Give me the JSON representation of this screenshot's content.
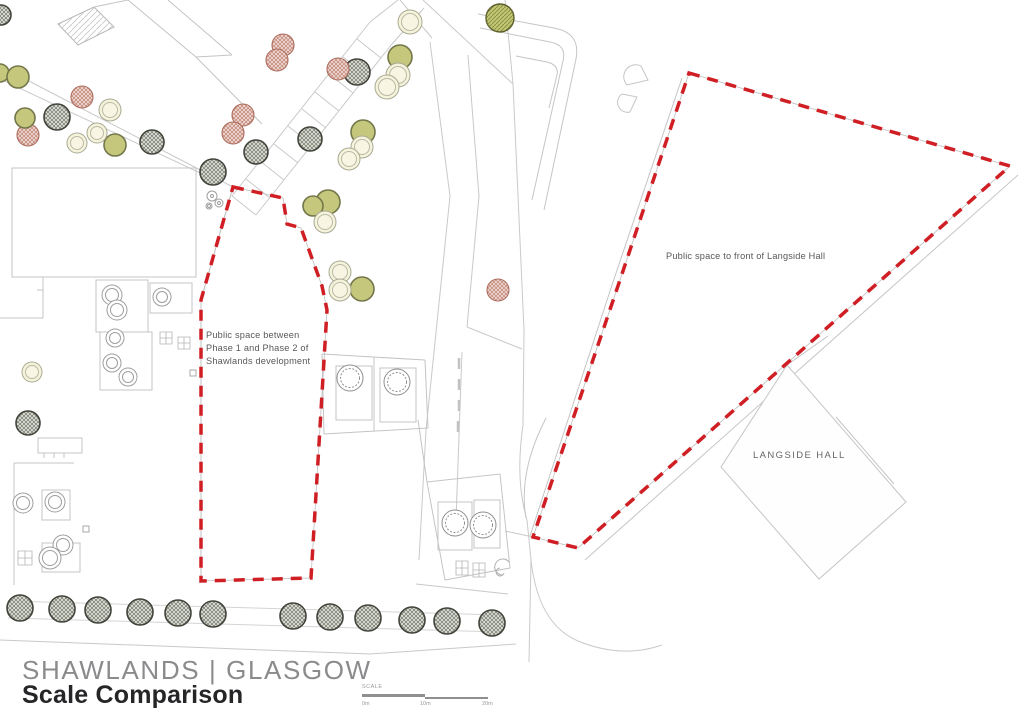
{
  "title": {
    "location": "SHAWLANDS | GLASGOW",
    "project": "Scale Comparison"
  },
  "scale_bar": {
    "label": "SCALE",
    "ticks": [
      "0m",
      "10m",
      "20m"
    ]
  },
  "left_map": {
    "annotation_lines": [
      "Public space between",
      "Phase 1 and Phase 2 of",
      "Shawlands development"
    ]
  },
  "right_map": {
    "annotation": "Public space to front of Langside Hall",
    "building_label": "LANGSIDE HALL"
  },
  "colors": {
    "boundary_red": "#d01f24",
    "map_line": "#c9c9c9",
    "tree_dark_outline": "#41443b",
    "tree_rust_outline": "#ad6c5e",
    "tree_olive_fill": "#c5c77c",
    "tree_pale_fill": "#f5f3da",
    "title_gray": "#8b8b8e",
    "title_black": "#262628"
  },
  "map_geometry": {
    "boundaries": [
      {
        "name": "shawlands-public-space-boundary",
        "points": [
          [
            233,
            187
          ],
          [
            283,
            198
          ],
          [
            287,
            224
          ],
          [
            301,
            228
          ],
          [
            322,
            286
          ],
          [
            327,
            310
          ],
          [
            311,
            578
          ],
          [
            201,
            581
          ],
          [
            201,
            300
          ]
        ]
      },
      {
        "name": "langside-public-space-boundary",
        "points": [
          [
            689,
            73
          ],
          [
            1010,
            166
          ],
          [
            578,
            548
          ],
          [
            533,
            537
          ],
          [
            620,
            280
          ]
        ]
      }
    ],
    "trees": [
      {
        "type": "dark",
        "x": 1,
        "y": 15,
        "r": 10
      },
      {
        "type": "dark",
        "x": 57,
        "y": 117,
        "r": 13
      },
      {
        "type": "dark",
        "x": 152,
        "y": 142,
        "r": 12
      },
      {
        "type": "dark",
        "x": 213,
        "y": 172,
        "r": 13
      },
      {
        "type": "dark",
        "x": 256,
        "y": 152,
        "r": 12
      },
      {
        "type": "dark",
        "x": 357,
        "y": 72,
        "r": 13
      },
      {
        "type": "dark",
        "x": 310,
        "y": 139,
        "r": 12
      },
      {
        "type": "dark",
        "x": 28,
        "y": 423,
        "r": 12
      },
      {
        "type": "dark",
        "x": 20,
        "y": 608,
        "r": 13
      },
      {
        "type": "dark",
        "x": 62,
        "y": 609,
        "r": 13
      },
      {
        "type": "dark",
        "x": 98,
        "y": 610,
        "r": 13
      },
      {
        "type": "dark",
        "x": 140,
        "y": 612,
        "r": 13
      },
      {
        "type": "dark",
        "x": 178,
        "y": 613,
        "r": 13
      },
      {
        "type": "dark",
        "x": 213,
        "y": 614,
        "r": 13
      },
      {
        "type": "dark",
        "x": 293,
        "y": 616,
        "r": 13
      },
      {
        "type": "dark",
        "x": 330,
        "y": 617,
        "r": 13
      },
      {
        "type": "dark",
        "x": 368,
        "y": 618,
        "r": 13
      },
      {
        "type": "dark",
        "x": 412,
        "y": 620,
        "r": 13
      },
      {
        "type": "dark",
        "x": 447,
        "y": 621,
        "r": 13
      },
      {
        "type": "dark",
        "x": 492,
        "y": 623,
        "r": 13
      },
      {
        "type": "oliveHatch",
        "x": 500,
        "y": 18,
        "r": 14
      },
      {
        "type": "rust",
        "x": 28,
        "y": 135,
        "r": 11
      },
      {
        "type": "rust",
        "x": 82,
        "y": 97,
        "r": 11
      },
      {
        "type": "rust",
        "x": 243,
        "y": 115,
        "r": 11
      },
      {
        "type": "rust",
        "x": 233,
        "y": 133,
        "r": 11
      },
      {
        "type": "rust",
        "x": 283,
        "y": 45,
        "r": 11
      },
      {
        "type": "rust",
        "x": 277,
        "y": 60,
        "r": 11
      },
      {
        "type": "rust",
        "x": 338,
        "y": 69,
        "r": 11
      },
      {
        "type": "rust",
        "x": 498,
        "y": 290,
        "r": 11
      },
      {
        "type": "olive",
        "x": 0,
        "y": 73,
        "r": 9
      },
      {
        "type": "olive",
        "x": 18,
        "y": 77,
        "r": 11
      },
      {
        "type": "olive",
        "x": 25,
        "y": 118,
        "r": 10
      },
      {
        "type": "olive",
        "x": 115,
        "y": 145,
        "r": 11
      },
      {
        "type": "olive",
        "x": 400,
        "y": 57,
        "r": 12
      },
      {
        "type": "olive",
        "x": 363,
        "y": 132,
        "r": 12
      },
      {
        "type": "olive",
        "x": 328,
        "y": 202,
        "r": 12
      },
      {
        "type": "olive",
        "x": 313,
        "y": 206,
        "r": 10
      },
      {
        "type": "olive",
        "x": 362,
        "y": 289,
        "r": 12
      },
      {
        "type": "pale",
        "x": 110,
        "y": 110,
        "r": 11
      },
      {
        "type": "pale",
        "x": 97,
        "y": 133,
        "r": 10
      },
      {
        "type": "pale",
        "x": 77,
        "y": 143,
        "r": 10
      },
      {
        "type": "pale",
        "x": 410,
        "y": 22,
        "r": 12
      },
      {
        "type": "pale",
        "x": 398,
        "y": 75,
        "r": 12
      },
      {
        "type": "pale",
        "x": 387,
        "y": 87,
        "r": 12
      },
      {
        "type": "pale",
        "x": 362,
        "y": 147,
        "r": 11
      },
      {
        "type": "pale",
        "x": 349,
        "y": 159,
        "r": 11
      },
      {
        "type": "pale",
        "x": 325,
        "y": 222,
        "r": 11
      },
      {
        "type": "pale",
        "x": 340,
        "y": 272,
        "r": 11
      },
      {
        "type": "pale",
        "x": 340,
        "y": 290,
        "r": 11
      },
      {
        "type": "pale",
        "x": 32,
        "y": 372,
        "r": 10
      },
      {
        "type": "open",
        "x": 112,
        "y": 295,
        "r": 10
      },
      {
        "type": "open",
        "x": 117,
        "y": 310,
        "r": 10
      },
      {
        "type": "open",
        "x": 162,
        "y": 297,
        "r": 9
      },
      {
        "type": "open",
        "x": 115,
        "y": 338,
        "r": 9
      },
      {
        "type": "open",
        "x": 112,
        "y": 363,
        "r": 9
      },
      {
        "type": "open",
        "x": 128,
        "y": 377,
        "r": 9
      },
      {
        "type": "open",
        "x": 23,
        "y": 503,
        "r": 10
      },
      {
        "type": "open",
        "x": 55,
        "y": 502,
        "r": 10
      },
      {
        "type": "open",
        "x": 63,
        "y": 545,
        "r": 10
      },
      {
        "type": "open",
        "x": 50,
        "y": 558,
        "r": 11
      },
      {
        "type": "open",
        "x": 212,
        "y": 196,
        "r": 5
      },
      {
        "type": "open",
        "x": 219,
        "y": 203,
        "r": 4
      },
      {
        "type": "open",
        "x": 209,
        "y": 206,
        "r": 3
      },
      {
        "type": "ornate",
        "x": 350,
        "y": 378,
        "r": 13
      },
      {
        "type": "ornate",
        "x": 397,
        "y": 382,
        "r": 13
      },
      {
        "type": "ornate",
        "x": 455,
        "y": 523,
        "r": 13
      },
      {
        "type": "ornate",
        "x": 483,
        "y": 525,
        "r": 13
      }
    ]
  }
}
